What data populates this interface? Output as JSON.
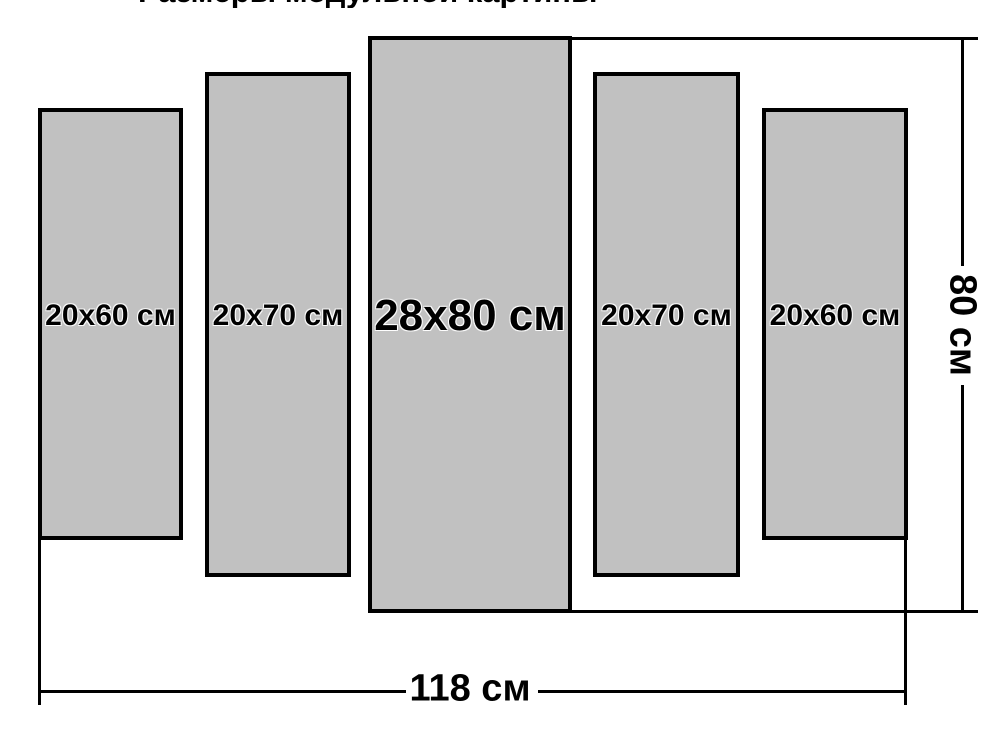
{
  "title": {
    "text": "Размеры модульной картины",
    "note_visible": "clipped at top edge, only letter bottoms visible"
  },
  "diagram": {
    "panels": [
      {
        "label": "20x60 см",
        "width_cm": 20,
        "height_cm": 60
      },
      {
        "label": "20x70 см",
        "width_cm": 20,
        "height_cm": 70
      },
      {
        "label": "28x80 см",
        "width_cm": 28,
        "height_cm": 80
      },
      {
        "label": "20x70 см",
        "width_cm": 20,
        "height_cm": 70
      },
      {
        "label": "20x60 см",
        "width_cm": 20,
        "height_cm": 60
      }
    ],
    "dimensions": {
      "total_width_label": "118 см",
      "total_width_cm": 118,
      "total_height_label": "80 см",
      "total_height_cm": 80
    },
    "colors": {
      "panel_fill": "#c1c1c1",
      "panel_border": "#000000",
      "dimension_line": "#000000",
      "background": "#ffffff",
      "text": "#000000"
    }
  }
}
